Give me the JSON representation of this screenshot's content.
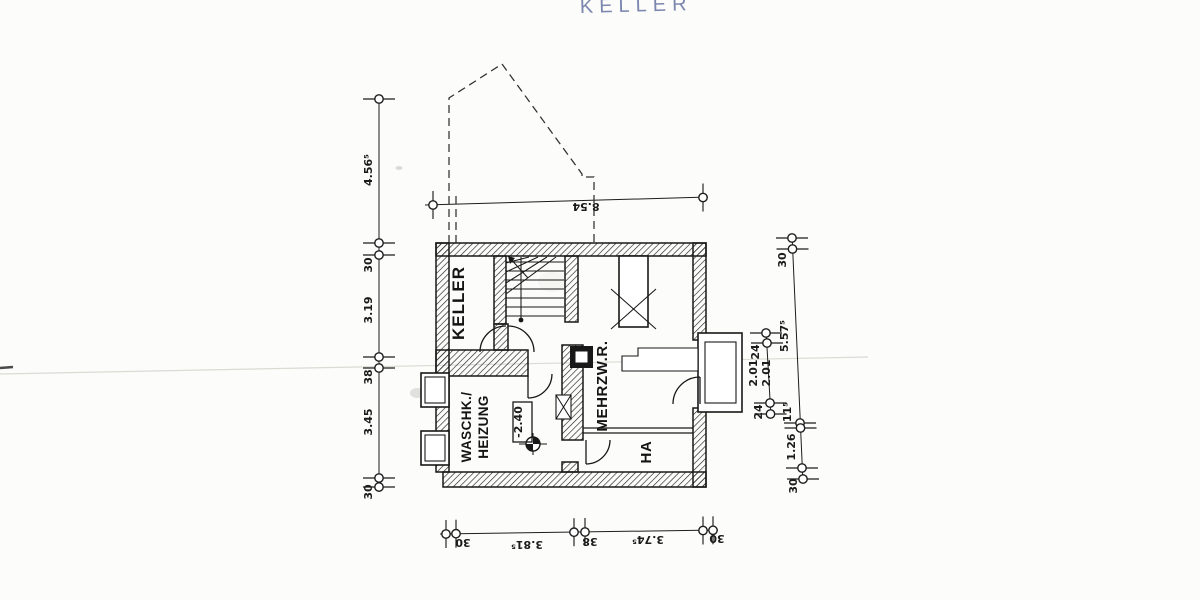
{
  "title": {
    "text": "KELLER"
  },
  "colors": {
    "ink": "#1b1b1b",
    "title_ink": "#6b77a6",
    "paper": "#fcfcfa"
  },
  "rooms": {
    "keller": "KELLER",
    "waschk_line1": "WASCHK./",
    "waschk_line2": "HEIZUNG",
    "mehrzw": "MEHRZW.R.",
    "ha": "HA",
    "level": "-2.40"
  },
  "dimensions": {
    "top": [
      "8.54"
    ],
    "bottom": [
      "30",
      "3.81⁵",
      "38",
      "3.74⁵",
      "30"
    ],
    "left": [
      "4.56⁵",
      "30",
      "3.19",
      "38",
      "3.45",
      "30"
    ],
    "right_inner": [
      "24",
      "2.01",
      "2.01",
      "24"
    ],
    "right_outer": [
      "30",
      "5.57⁵",
      "11⁵",
      "1.26",
      "30"
    ]
  }
}
